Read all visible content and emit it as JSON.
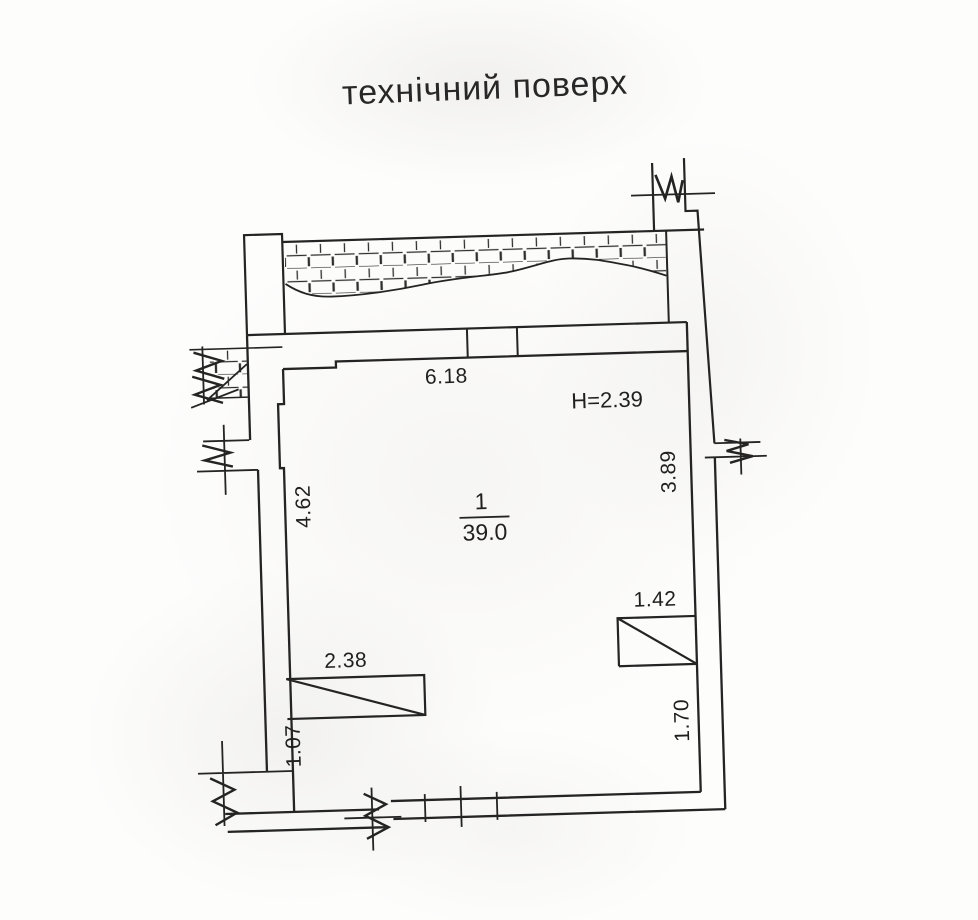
{
  "title": "технічний поверх",
  "room": {
    "number": "1",
    "area": "39.0",
    "height_label": "H=2.39"
  },
  "dims": {
    "top_width": "6.18",
    "left_upper": "4.62",
    "right_upper": "3.89",
    "shaft_right_width": "1.42",
    "shaft_left_width": "2.38",
    "left_lower": "1.07",
    "right_lower": "1.70"
  },
  "colors": {
    "ink": "#242424",
    "text": "#1f1f1f",
    "paper": "#fdfdfc"
  }
}
